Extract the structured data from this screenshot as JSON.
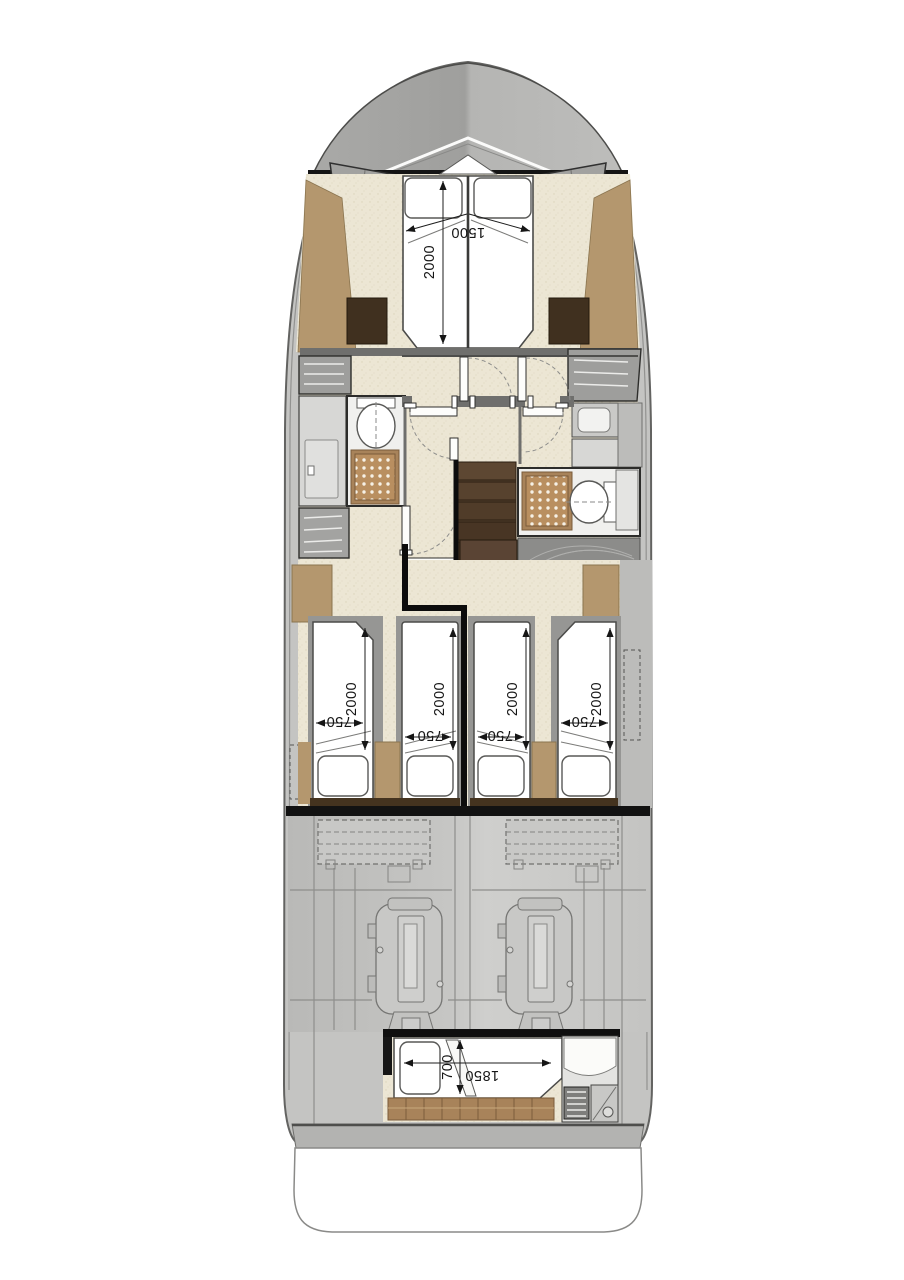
{
  "document": {
    "type": "Motor yacht lower-deck floor plan",
    "background": "#ffffff"
  },
  "dimensions_mm": {
    "owner_bed": {
      "width": "1500",
      "length": "2000"
    },
    "guest_bed": {
      "width": "750",
      "length": "2000"
    },
    "crew_bed": {
      "width": "700",
      "length": "1850"
    }
  },
  "colors": {
    "hull_deck": "#c4c4c2",
    "bow_deck_dark": "#a5a5a3",
    "bow_deck_light": "#bababa",
    "bulkhead_black": "#121212",
    "cabin_floor_cream": "#ece6d4",
    "wood_trim": "#b4976e",
    "teak_floor": "#a8835a",
    "stair_wood_dark": "#54402d",
    "wall_gray": "#6f6f6d",
    "engine_room_gray": "#c2c2c0",
    "furniture_white": "#ffffff"
  }
}
